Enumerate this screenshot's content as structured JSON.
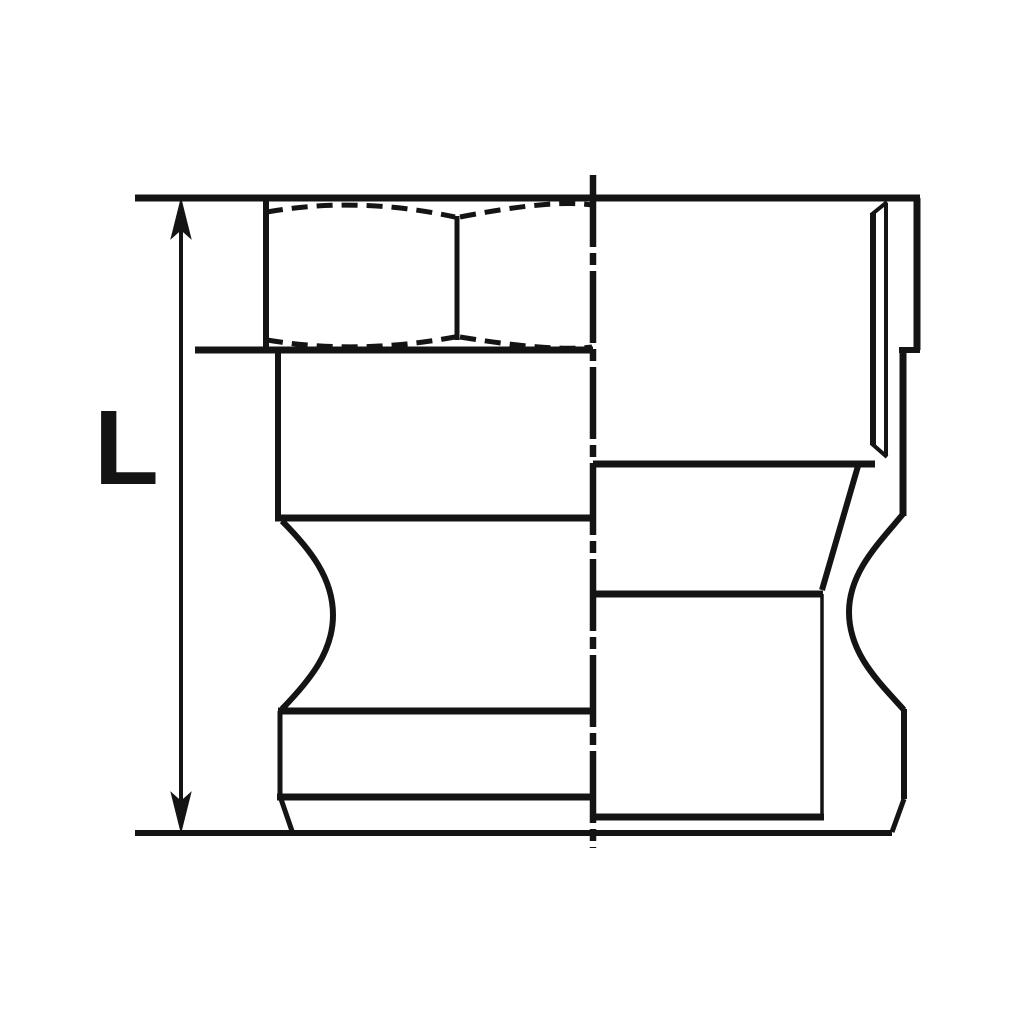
{
  "dimension_label": "L",
  "colors": {
    "line": "#141414",
    "background": "#ffffff"
  },
  "drawing": {
    "canvas": {
      "width": 1024,
      "height": 1024
    },
    "elements": [
      {
        "name": "top-edge-line",
        "type": "line",
        "x1": 135,
        "y1": 198,
        "x2": 920,
        "y2": 198,
        "w": 7
      },
      {
        "name": "bottom-extension-line",
        "type": "line",
        "x1": 135,
        "y1": 833,
        "x2": 892,
        "y2": 833,
        "w": 6
      },
      {
        "name": "dimension-line",
        "type": "line",
        "x1": 181,
        "y1": 228,
        "x2": 181,
        "y2": 804,
        "w": 4
      },
      {
        "name": "dimension-arrow-up",
        "type": "polygon",
        "points": "181,201 172,237 181,229 190,237"
      },
      {
        "name": "dimension-arrow-down",
        "type": "polygon",
        "points": "181,830 172,794 181,802 190,794"
      },
      {
        "name": "vertical-centerline",
        "type": "line",
        "x1": 593,
        "y1": 175,
        "x2": 593,
        "y2": 848,
        "w": 6.5,
        "dash": "72 6 12 6"
      },
      {
        "name": "hex-left-edge",
        "type": "line",
        "x1": 266,
        "y1": 198,
        "x2": 266,
        "y2": 351,
        "w": 6
      },
      {
        "name": "hex-corner-edge",
        "type": "line",
        "x1": 457,
        "y1": 216,
        "x2": 457,
        "y2": 340,
        "w": 5
      },
      {
        "name": "hex-chamfer-arc-top-left",
        "type": "path",
        "d": "M 267,212 Q 358,196 455,217",
        "w": 5,
        "dash": "16 9"
      },
      {
        "name": "hex-chamfer-arc-top-right",
        "type": "path",
        "d": "M 460,217 Q 552,199 592,205",
        "w": 5,
        "dash": "16 9"
      },
      {
        "name": "hex-chamfer-arc-bottom-left",
        "type": "path",
        "d": "M 267,340 Q 358,355 455,337",
        "w": 5,
        "dash": "16 9"
      },
      {
        "name": "hex-chamfer-arc-bottom-right",
        "type": "path",
        "d": "M 460,337 Q 552,352 592,347",
        "w": 5,
        "dash": "16 9"
      },
      {
        "name": "hex-bottom-line",
        "type": "line",
        "x1": 195,
        "y1": 350,
        "x2": 593,
        "y2": 350,
        "w": 7
      },
      {
        "name": "upper-body-left-edge",
        "type": "line",
        "x1": 278,
        "y1": 347,
        "x2": 278,
        "y2": 518,
        "w": 6
      },
      {
        "name": "upper-body-bottom-line",
        "type": "line",
        "x1": 275,
        "y1": 518,
        "x2": 593,
        "y2": 518,
        "w": 7
      },
      {
        "name": "left-cam-groove",
        "type": "path",
        "d": "M 282,521 C 310,549 333,578 333,615 C 333,652 310,680 282,709",
        "w": 6
      },
      {
        "name": "shank-top-line",
        "type": "line",
        "x1": 278,
        "y1": 711,
        "x2": 593,
        "y2": 711,
        "w": 7
      },
      {
        "name": "shank-left-edge",
        "type": "line",
        "x1": 280,
        "y1": 711,
        "x2": 280,
        "y2": 798,
        "w": 5
      },
      {
        "name": "shank-step-line",
        "type": "line",
        "x1": 277,
        "y1": 797,
        "x2": 593,
        "y2": 797,
        "w": 7
      },
      {
        "name": "left-tip-chamfer",
        "type": "line",
        "x1": 281,
        "y1": 799,
        "x2": 292,
        "y2": 831,
        "w": 5
      },
      {
        "name": "right-outer-edge-upper",
        "type": "line",
        "x1": 917,
        "y1": 198,
        "x2": 917,
        "y2": 350,
        "w": 7
      },
      {
        "name": "right-step-line",
        "type": "line",
        "x1": 899,
        "y1": 350,
        "x2": 920,
        "y2": 350,
        "w": 6
      },
      {
        "name": "right-outer-edge-mid",
        "type": "line",
        "x1": 903,
        "y1": 347,
        "x2": 903,
        "y2": 516,
        "w": 7
      },
      {
        "name": "end-chamfer-face-edge",
        "type": "line",
        "x1": 873,
        "y1": 213,
        "x2": 873,
        "y2": 445,
        "w": 6
      },
      {
        "name": "end-chamfer-inner-edge",
        "type": "line",
        "x1": 886,
        "y1": 203,
        "x2": 886,
        "y2": 456,
        "w": 4
      },
      {
        "name": "end-chamfer-top-diagonal",
        "type": "line",
        "x1": 871,
        "y1": 215,
        "x2": 887,
        "y2": 202,
        "w": 4
      },
      {
        "name": "end-chamfer-bottom-diagonal",
        "type": "line",
        "x1": 871,
        "y1": 443,
        "x2": 887,
        "y2": 457,
        "w": 4
      },
      {
        "name": "cylinder-bottom-line",
        "type": "line",
        "x1": 593,
        "y1": 464,
        "x2": 875,
        "y2": 464,
        "w": 7
      },
      {
        "name": "right-taper-diagonal",
        "type": "line",
        "x1": 858,
        "y1": 466,
        "x2": 822,
        "y2": 590,
        "w": 6
      },
      {
        "name": "male-end-top-line",
        "type": "line",
        "x1": 593,
        "y1": 594,
        "x2": 823,
        "y2": 594,
        "w": 7
      },
      {
        "name": "male-end-right-edge",
        "type": "line",
        "x1": 822,
        "y1": 594,
        "x2": 822,
        "y2": 817,
        "w": 3.5
      },
      {
        "name": "male-end-bottom-line",
        "type": "line",
        "x1": 593,
        "y1": 817,
        "x2": 824,
        "y2": 817,
        "w": 7
      },
      {
        "name": "right-cam-groove",
        "type": "path",
        "d": "M 903,514 C 879,543 849,572 849,612 C 849,654 879,682 904,710",
        "w": 6
      },
      {
        "name": "right-lower-edge",
        "type": "line",
        "x1": 904,
        "y1": 709,
        "x2": 904,
        "y2": 799,
        "w": 6
      },
      {
        "name": "right-tip-chamfer",
        "type": "line",
        "x1": 904,
        "y1": 799,
        "x2": 892,
        "y2": 832,
        "w": 5
      }
    ]
  }
}
